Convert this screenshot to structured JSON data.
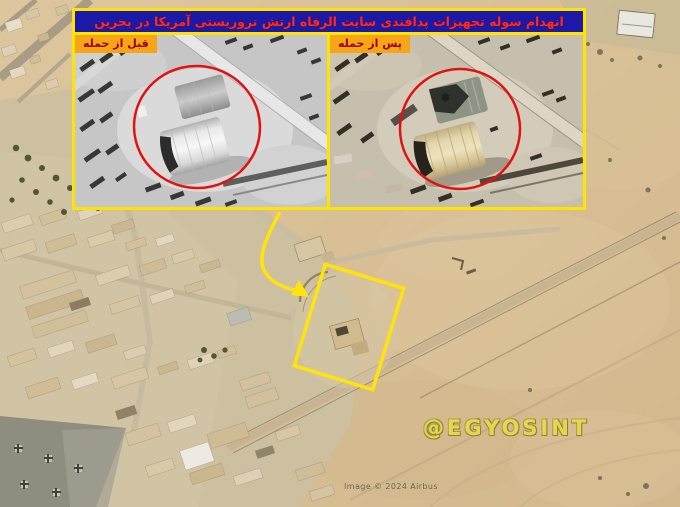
{
  "header": {
    "title": "انهدام سوله تجهیزات پدافندی سایت الرفاه ارتش تروریستی آمریکا در بحرین"
  },
  "inset": {
    "before_label": "قبل از حمله",
    "after_label": "پس از حمله"
  },
  "watermark_text": "@EGYOSINT",
  "attribution_text": "Image © 2024 Airbus",
  "colors": {
    "panel_border": "#FFE400",
    "title_bg": "#1C18A8",
    "title_text": "#FF2A1A",
    "label_bg": "#F6A519",
    "label_text": "#9B0000",
    "annotation_yellow": "#FFE40A",
    "highlight_circle_red": "#E01313",
    "sand": "#D8BF96"
  }
}
